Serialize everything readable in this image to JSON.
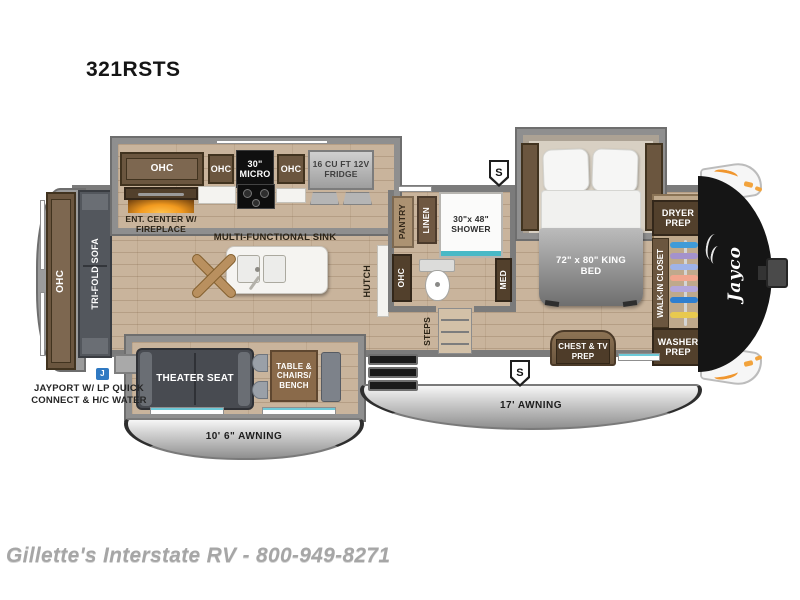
{
  "title": "321RSTS",
  "footer": "Gillette's Interstate RV - 800-949-8271",
  "brand": "Jayco",
  "badges": {
    "speaker": "S",
    "jayport": "J"
  },
  "labels": {
    "ohc": "OHC",
    "micro_line1": "30\"",
    "micro_line2": "MICRO",
    "fridge": "16 CU FT 12V FRIDGE",
    "ent_center": "ENT. CENTER W/ FIREPLACE",
    "sink": "MULTI-FUNCTIONAL SINK",
    "tri_fold_sofa": "TRI-FOLD SOFA",
    "hutch": "HUTCH",
    "pantry": "PANTRY",
    "linen": "LINEN",
    "shower": "30\"x 48\" SHOWER",
    "med": "MED",
    "steps": "STEPS",
    "king_bed": "72\" x 80\" KING BED",
    "chest_tv": "CHEST & TV PREP",
    "walk_in_closet": "WALK-IN CLOSET",
    "dryer_prep": "DRYER PREP",
    "washer_prep": "WASHER PREP",
    "theater_seat": "THEATER SEAT",
    "table_chairs": "TABLE & CHAIRS/ BENCH",
    "awning_17": "17' AWNING",
    "awning_10_6": "10' 6\" AWNING",
    "jayport": "JAYPORT W/ LP QUICK CONNECT & H/C WATER"
  },
  "colors": {
    "floor": "#c9b49c",
    "cabinet_brown": "#6b563f",
    "wall_gray": "#7b7b7b",
    "awning_silver": "#c9c9c9",
    "fireplace_orange": "#f29a1f",
    "shower_trim_teal": "#6cc9d8",
    "front_cap_black": "#151515",
    "marker_light_orange": "#f2a33c",
    "jayport_badge_blue": "#2f79c2",
    "hangers": [
      "#3f9bd8",
      "#a492cc",
      "#9fb3e8",
      "#f0a58e",
      "#b4a6da",
      "#2f7fd0",
      "#e8c94f"
    ]
  }
}
